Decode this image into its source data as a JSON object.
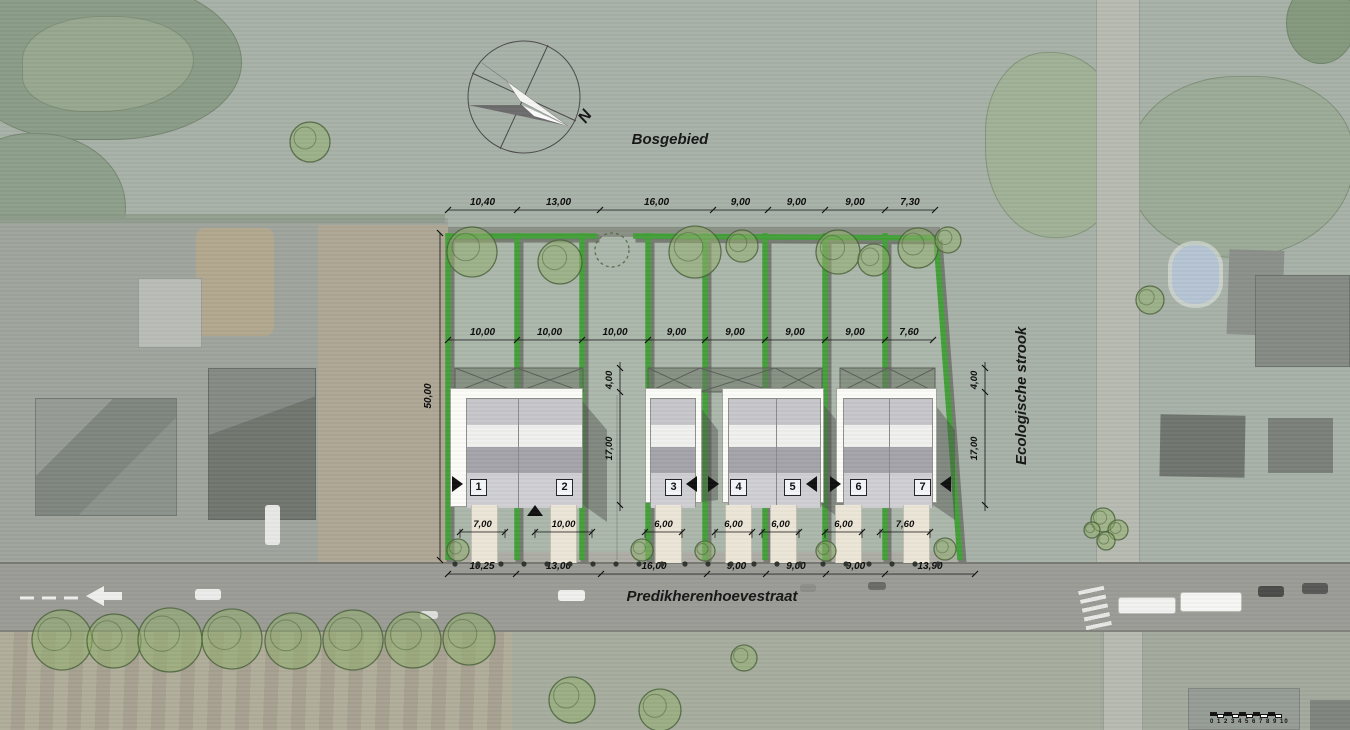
{
  "plan": {
    "area_label": "Bosgebied",
    "street_label": "Predikherenhoevestraat",
    "eco_label": "Ecologische strook",
    "north_label": "N"
  },
  "houses": {
    "numbers": [
      "1",
      "2",
      "3",
      "4",
      "5",
      "6",
      "7"
    ]
  },
  "dimensions": {
    "top_row": [
      "10,40",
      "13,00",
      "16,00",
      "9,00",
      "9,00",
      "9,00",
      "7,30"
    ],
    "mid_row": [
      "10,00",
      "10,00",
      "10,00",
      "9,00",
      "9,00",
      "9,00",
      "9,00",
      "7,60"
    ],
    "frontage_row": [
      "7,00",
      "10,00",
      "6,00",
      "6,00",
      "6,00",
      "6,00",
      "7,60"
    ],
    "street_row": [
      "10,25",
      "13,00",
      "16,00",
      "9,00",
      "9,00",
      "9,00",
      "13,90"
    ],
    "depth_left": "50,00",
    "gap_dims": [
      "4,00",
      "17,00"
    ],
    "right_dims": [
      "4,00",
      "17,00"
    ]
  },
  "scale_bar": {
    "numbers_text": "0 1 2 3 4 5 6 7 8 9 10"
  },
  "colors": {
    "hedge_green": "#44a13a",
    "hedge_shadow": "#767b72",
    "driveway_cream": "#ece6d7",
    "garden_white": "#fbfbf7",
    "roof_light": "#c7c7cb",
    "roof_dark": "#a4a4aa",
    "facade_gray": "#d0d0d4",
    "pool_blue": "#b5c4d3",
    "street_gray": "#9c9c97",
    "tree_fill": "rgba(146,175,110,0.55)",
    "tree_stroke": "rgba(70,95,55,0.8)"
  }
}
